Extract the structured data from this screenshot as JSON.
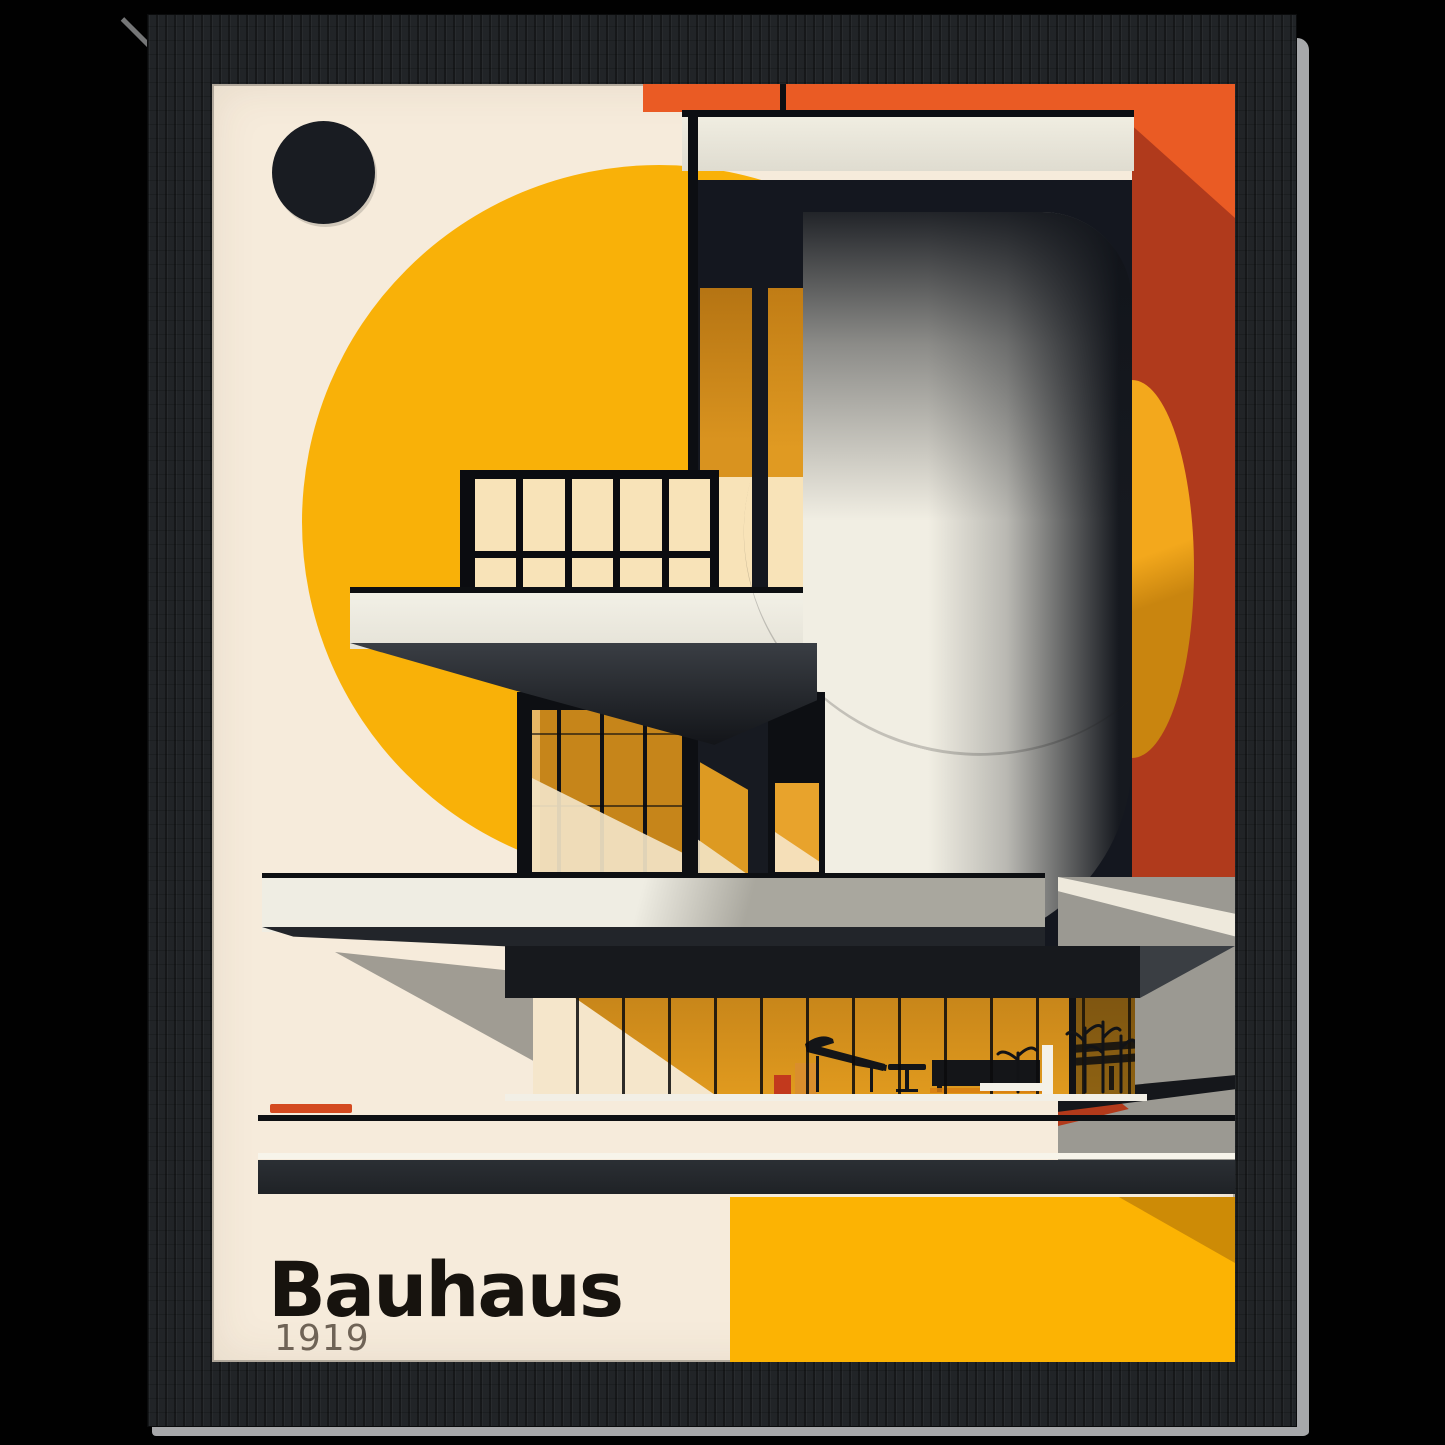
{
  "poster": {
    "title": "Bauhaus",
    "year": "1919",
    "style": "Bauhaus architecture art print, black wood frame"
  },
  "palette": {
    "background_cream": "#f6ebdb",
    "sun_yellow": "#f9b108",
    "bottom_yellow": "#fcb303",
    "orange": "#ea5b24",
    "brick_red": "#b03a1c",
    "building_black": "#14171f",
    "amber_window": "#c9881a",
    "pale_pane": "#f8e3b8",
    "slab_white": "#efede3",
    "shadow_gray": "#9b9992",
    "frame_black": "#212427",
    "title_ink": "#17130e",
    "year_gray": "#6f6356",
    "accent_red_bar": "#d44a20"
  },
  "artwork": {
    "elements": [
      "black-dot",
      "yellow-sun-circle",
      "orange-top-band",
      "red-side-panel",
      "modernist-building",
      "balcony-window-grid",
      "amber-curtain-windows",
      "rounded-white-tower",
      "cantilever-slabs",
      "ground-floor-glass-wall",
      "furniture-silhouettes",
      "red-accent-bar",
      "black-baseline-bar",
      "yellow-bottom-block",
      "title-text",
      "year-text"
    ]
  }
}
